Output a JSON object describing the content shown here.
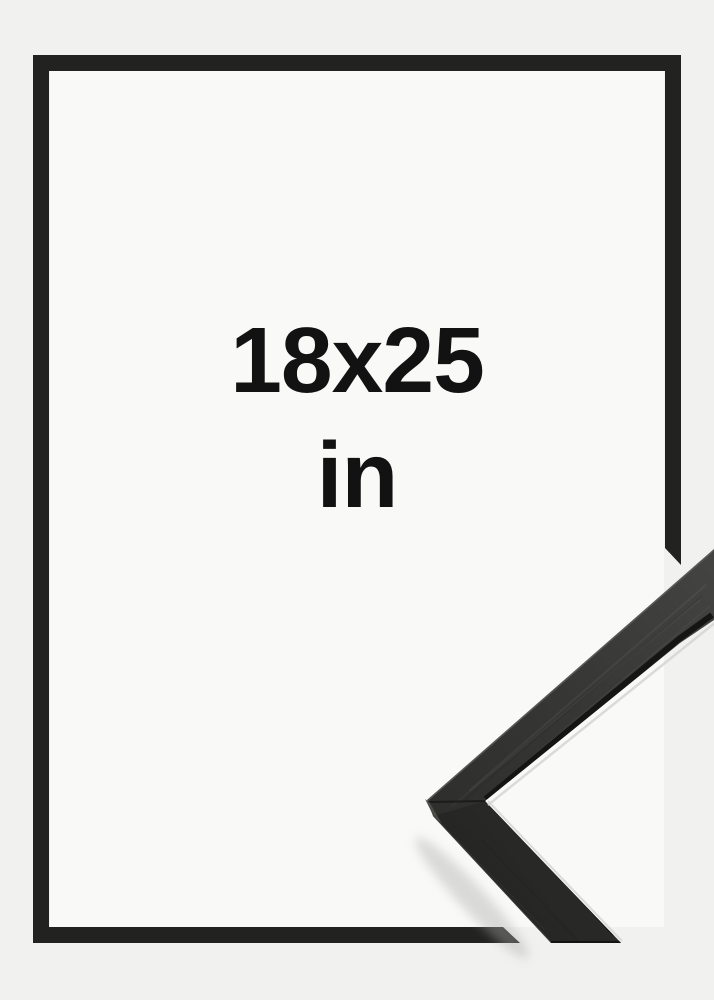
{
  "size_label": {
    "dimensions": "18x25",
    "unit": "in"
  },
  "graphic": {
    "frame_outline_shape": "rectangular-outline-with-mitred-break-bottom-right",
    "corner_photo": "black-wooden-frame-moulding-corner-closeup"
  },
  "colors": {
    "background": "#f1f1ef",
    "inner_background": "#f9f9f8",
    "frame_outline": "#222220",
    "label_text": "#121212",
    "moulding_dark": "#262624",
    "moulding_light": "#3c3c3a",
    "moulding_edge_highlight": "#5f5f5a",
    "moulding_inner_lip": "#131311"
  }
}
